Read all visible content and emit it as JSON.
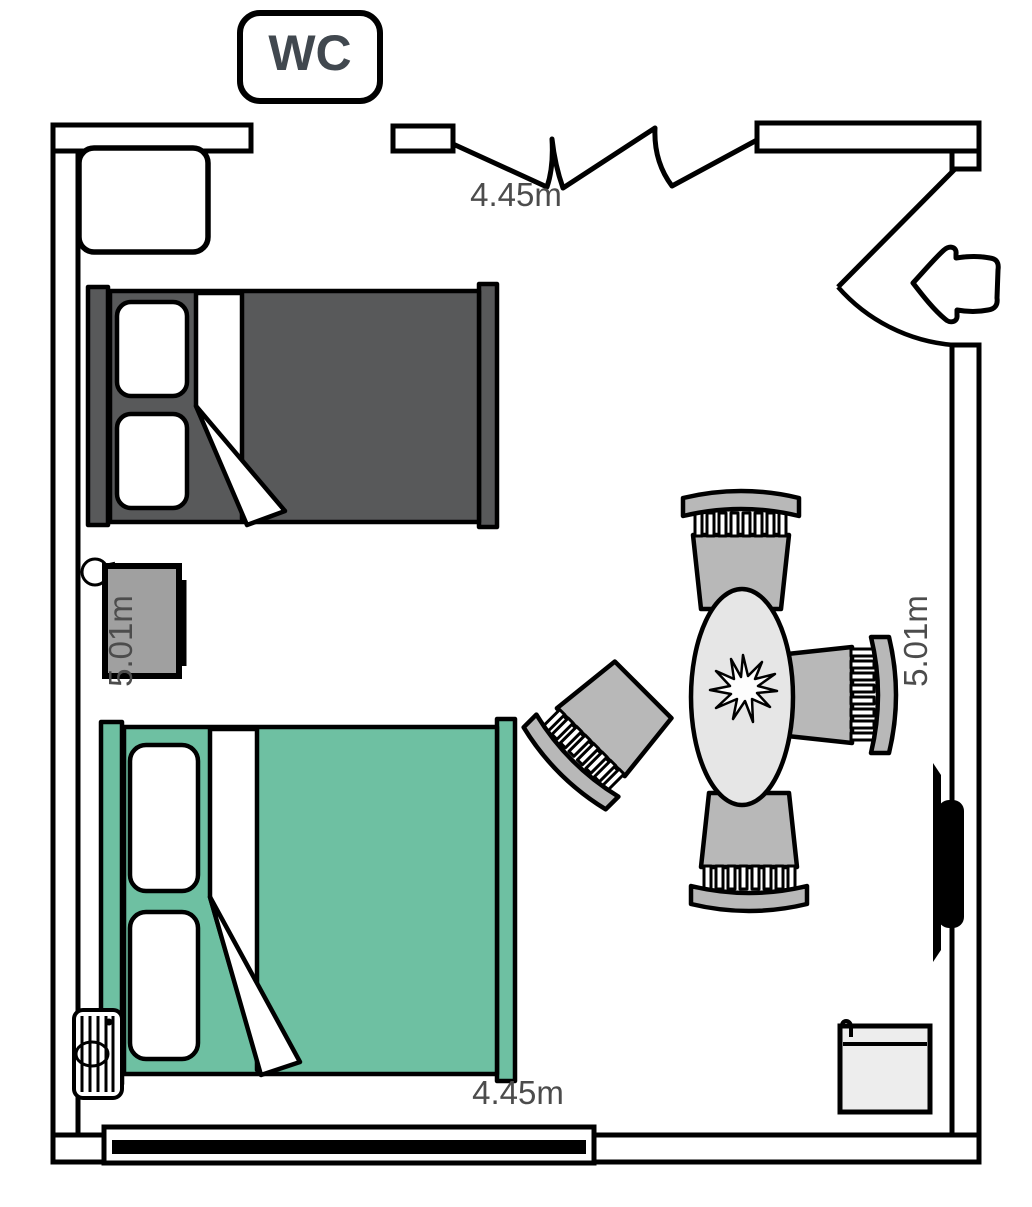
{
  "floor_plan": {
    "room_label": "WC",
    "dimensions": {
      "top": "4.45m",
      "bottom": "4.45m",
      "left": "5.01m",
      "right": "5.01m"
    }
  },
  "colors": {
    "wall_line": "#000000",
    "bed_dark_gray": "#58595a",
    "bed_teal": "#6ec0a2",
    "pillow_white": "#ffffff",
    "nightstand_gray": "#a0a0a0",
    "chair_gray": "#b8b8b8",
    "table_gray": "#e6e6e6",
    "bin_gray": "#ededed",
    "tv_black": "#000000",
    "dimension_text": "#4c4c4c",
    "wc_text": "#41484f"
  }
}
